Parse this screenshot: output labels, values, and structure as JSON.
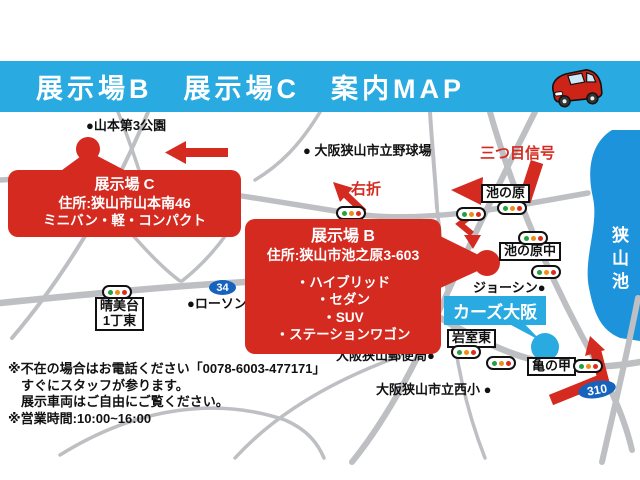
{
  "header": {
    "title": "展示場B　展示場C　案内MAP"
  },
  "sites": {
    "c": {
      "title": "展示場 C",
      "address": "住所:狭山市山本南46",
      "vehicles": "ミニバン・軽・コンパクト"
    },
    "b": {
      "title": "展示場 B",
      "address": "住所:狭山市池之原3-603",
      "vehicles": [
        "・ハイブリッド",
        "・セダン",
        "・SUV",
        "・ステーションワゴン"
      ]
    }
  },
  "directions": {
    "third_signal": "三つ目信号",
    "right_turn": "右折"
  },
  "landmarks": {
    "yamamoto_park": "●山本第3公園",
    "baseball_stadium": "● 大阪狭山市立野球場",
    "joshin": "ジョーシン●",
    "lawson": "●ローソン",
    "post_office": "大阪狭山郵便局●",
    "nishi_elementary": "大阪狭山市立西小 ●",
    "cars_osaka": "カーズ大阪",
    "sayama_lake": "狭山池"
  },
  "intersections": {
    "ike_no_hara": "池の原",
    "ike_no_hara_naka": "池の原中",
    "iwamuro_higashi": "岩室東",
    "kame_no_ko": "亀の甲",
    "harumidai_line1": "晴美台",
    "harumidai_line2": "1丁東"
  },
  "routes": {
    "r34": "34",
    "r310": "310"
  },
  "notes": {
    "line1": "※不在の場合はお電話ください「0078-6003-477171」",
    "line2": "すぐにスタッフが参ります。",
    "line3": "展示車両はご自由にご覧ください。",
    "line4": "※営業時間:10:00~16:00"
  },
  "colors": {
    "header_blue": "#29ABE2",
    "map_red": "#D42A20",
    "lake_blue": "#1D93DB",
    "route_badge_blue": "#1663BE",
    "road_gray": "#BDBFC3"
  }
}
